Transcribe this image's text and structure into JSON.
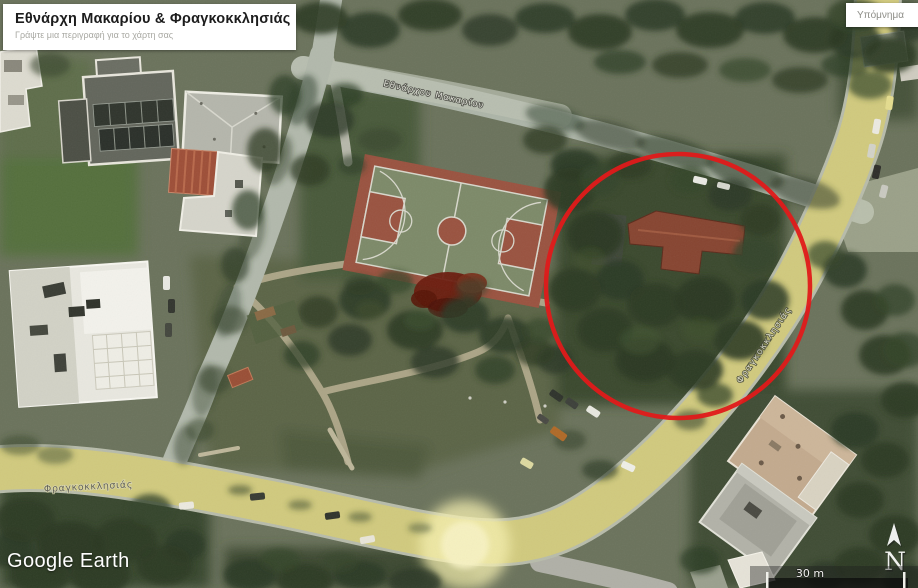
{
  "window": {
    "watermark": "Google Earth"
  },
  "title_card": {
    "title": "Εθνάρχη Μακαρίου & Φραγκοκκλησιάς",
    "subtitle": "Γράψτε μια περιγραφή για το χάρτη σας"
  },
  "legend": {
    "label": "Υπόμνημα"
  },
  "map": {
    "street_labels": [
      {
        "text": "Εθνάρχου Μακαρίου"
      },
      {
        "text": "Φραγκοκκλησιάς"
      },
      {
        "text": "Φραγκοκκλησιάς"
      }
    ],
    "compass": {
      "letter": "N"
    },
    "scale_bar": {
      "label": "30 m"
    },
    "annotation": {
      "shape": "circle",
      "color": "#e01a1a"
    },
    "colors": {
      "route_highlight": "#d2cb79",
      "route_glow": "#f7f1b0"
    }
  }
}
